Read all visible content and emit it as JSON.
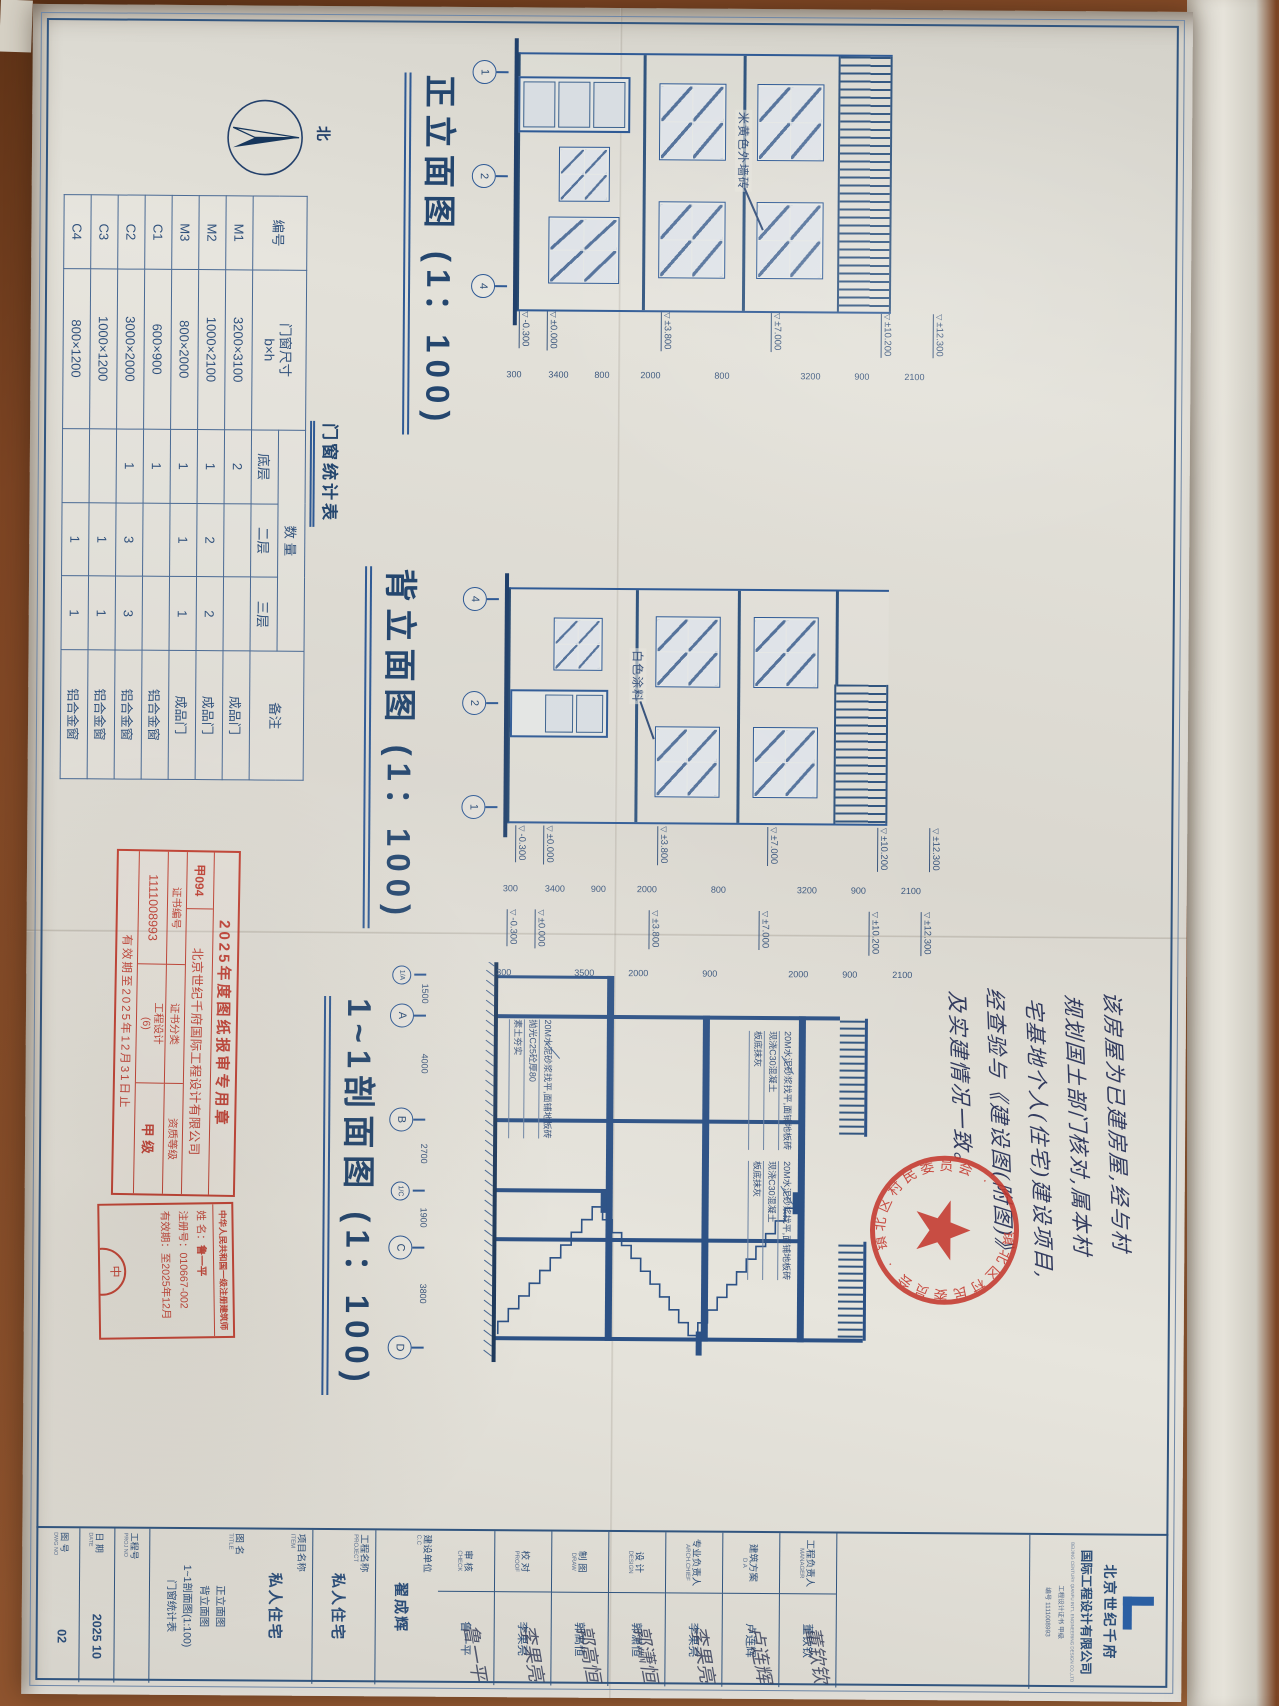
{
  "compass": {
    "label": "北"
  },
  "front_elevation": {
    "title": "正立面图 (1：100)",
    "material_label": "米黄色外墙砖",
    "axis": [
      "1",
      "2",
      "4"
    ],
    "dims": [
      "2100",
      "900",
      "3200",
      "800",
      "2000",
      "800",
      "3400",
      "300"
    ]
  },
  "rear_elevation": {
    "title": "背立面图 (1：100)",
    "material_label": "白色涂料",
    "axis": [
      "4",
      "2",
      "1"
    ],
    "dims": [
      "2100",
      "900",
      "3200",
      "800",
      "2000",
      "900",
      "3400",
      "300"
    ]
  },
  "section": {
    "title": "1~1剖面图 (1：100)",
    "axis": [
      "1/A",
      "A",
      "B",
      "1/C",
      "C",
      "D"
    ],
    "axis_dims": [
      "1500",
      "4000",
      "2700",
      "1900",
      "3800"
    ],
    "dims": [
      "2100",
      "900",
      "2000",
      "900",
      "2000",
      "3500",
      "300"
    ],
    "floor_note": [
      "20M水泥砂浆找平,面铺地板砖",
      "现浇C30混凝土",
      "板底抹灰"
    ],
    "ground_note": [
      "20M水泥砂浆找平,面铺地板砖",
      "抛光C25砼厚80",
      "素土夯实"
    ]
  },
  "levels": [
    "±12.300",
    "±10.200",
    "±7.000",
    "±3.800",
    "±0.000",
    "-0.300"
  ],
  "schedule": {
    "title": "门窗统计表",
    "headers": {
      "id": "编号",
      "size": "门窗尺寸",
      "size_sub": "b×h",
      "qty": "数  量",
      "floors": [
        "底层",
        "二层",
        "三层"
      ],
      "remark": "备注"
    },
    "rows": [
      {
        "id": "M1",
        "size": "3200×3100",
        "f1": "2",
        "f2": "",
        "f3": "",
        "remark": "成品门"
      },
      {
        "id": "M2",
        "size": "1000×2100",
        "f1": "1",
        "f2": "2",
        "f3": "2",
        "remark": "成品门"
      },
      {
        "id": "M3",
        "size": "800×2000",
        "f1": "1",
        "f2": "1",
        "f3": "1",
        "remark": "成品门"
      },
      {
        "id": "C1",
        "size": "600×900",
        "f1": "1",
        "f2": "",
        "f3": "",
        "remark": "铝合金窗"
      },
      {
        "id": "C2",
        "size": "3000×2000",
        "f1": "1",
        "f2": "3",
        "f3": "3",
        "remark": "铝合金窗"
      },
      {
        "id": "C3",
        "size": "1000×1200",
        "f1": "",
        "f2": "1",
        "f3": "1",
        "remark": "铝合金窗"
      },
      {
        "id": "C4",
        "size": "800×1200",
        "f1": "",
        "f2": "1",
        "f3": "1",
        "remark": "铝合金窗"
      }
    ]
  },
  "handwriting": {
    "lines": [
      "该房屋为已建房屋,经与村",
      "规划国土部门核对,属本村",
      "宅基地个人(住宅)建设项目,",
      "经查验与《建设图(附图)》",
      "及实建情况一致。"
    ]
  },
  "stamps": {
    "approval": {
      "line1": "2025年度图纸报审专用章",
      "code": "甲094",
      "company": "北京世纪千府国际工程设计有限公司",
      "h1": "证书编号",
      "h2": "证书分类",
      "h3": "资质等级",
      "v1": "1111008993",
      "v2": "工程设计",
      "v2b": "(6)",
      "v3": "甲 级",
      "footer": "有效期至2025年12月31日止"
    },
    "architect": {
      "title": "中华人民共和国一级注册建筑师",
      "name_label": "姓 名：",
      "name": "鲁一平",
      "reg_label": "注册号：",
      "reg": "010667-002",
      "valid_label": "有效期：",
      "valid": "至2025年12月",
      "seal_char": "中"
    },
    "committee": {
      "ring": "镇北区村民委员会 · 镇北区村民委员会 ·"
    }
  },
  "titleblock": {
    "company_cn1": "北京世纪千府",
    "company_cn2": "国际工程设计有限公司",
    "company_en": "BEIJING CENTURY QIANFU INT'L ENGINEERING DESIGN CO.,LTD",
    "cert1": "工程设计证书 甲级",
    "cert2": "编号 1111008993",
    "sign_rows": [
      {
        "cn": "工程负责人",
        "en": "MANAGER",
        "name": "董钦钦",
        "sig": "董钦钦"
      },
      {
        "cn": "建筑方案",
        "en": "D A",
        "name": "卢连辉",
        "sig": "卢连辉"
      },
      {
        "cn": "专业负责人",
        "en": "ARCH.CHIEF",
        "name": "李果亮",
        "sig": "李果亮"
      },
      {
        "cn": "设 计",
        "en": "DESIGN",
        "name": "郭潇恒",
        "sig": "郭潇恒"
      },
      {
        "cn": "制 图",
        "en": "DRAW",
        "name": "郭高恒",
        "sig": "郭高恒"
      },
      {
        "cn": "校 对",
        "en": "PROOF",
        "name": "李果亮",
        "sig": "李果亮"
      },
      {
        "cn": "审 核",
        "en": "CHECK",
        "name": "鲁一平",
        "sig": "鲁一平"
      }
    ],
    "info_rows": [
      {
        "cn": "建设单位",
        "en": "C.C",
        "value": "翟成辉"
      },
      {
        "cn": "工程名称",
        "en": "PROJECT",
        "value": "私人住宅"
      },
      {
        "cn": "项目名称",
        "en": "ITEM",
        "value": "私人住宅"
      }
    ],
    "drawing_title": {
      "cn": "图 名",
      "en": "TITLE",
      "lines": [
        "正立面图",
        "背立面图",
        "1~1剖面图(1:100)",
        "门窗统计表"
      ]
    },
    "bottom_rows": [
      {
        "cn": "工程号",
        "en": "PROJ NO",
        "value": ""
      },
      {
        "cn": "日 期",
        "en": "DATE",
        "value": "2025 10"
      },
      {
        "cn": "图 号",
        "en": "DWG NO",
        "value": "02"
      }
    ]
  }
}
